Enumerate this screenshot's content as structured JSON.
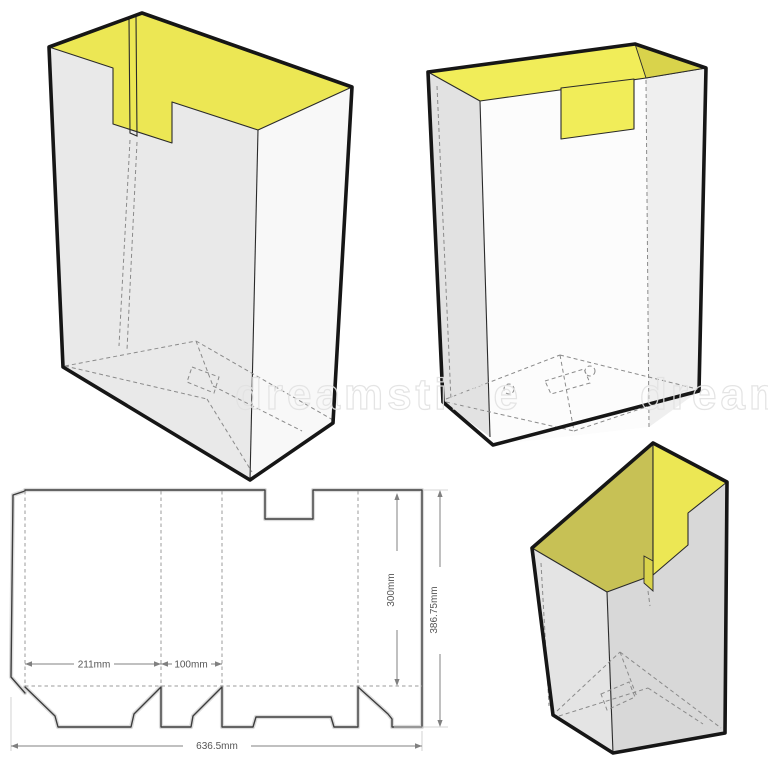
{
  "illustration": {
    "watermark_text": "dreamstime"
  },
  "dieline": {
    "labels": {
      "panel_width": "211mm",
      "gusset_width": "100mm",
      "panel_height": "300mm",
      "total_height": "386.75mm",
      "total_width": "636.5mm"
    }
  },
  "colors": {
    "interior_yellow": "#ece754",
    "interior_yellow_bright": "#f1ed59",
    "interior_yellow_olive": "#c7c155",
    "interior_yellow_deep": "#d9d34b",
    "outline": "#161616",
    "dieline_line": "#3d3d3d",
    "watermark": "#e2e2e2"
  }
}
